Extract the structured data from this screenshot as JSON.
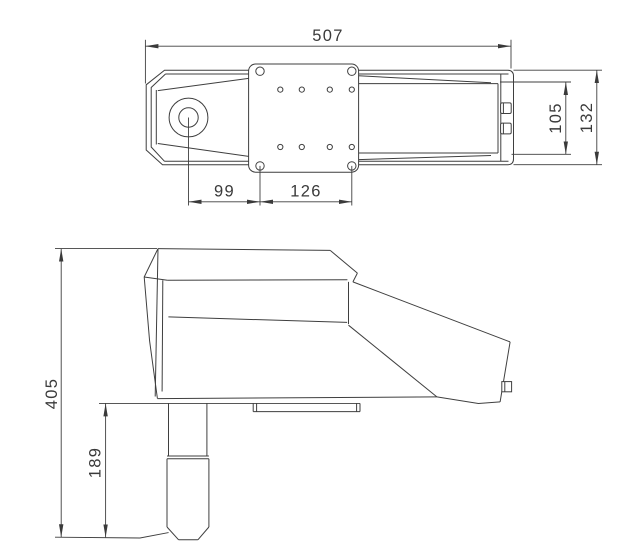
{
  "drawing": {
    "type": "technical-orthographic-drawing",
    "views": {
      "top_view": "device top view with mounting plate",
      "side_view": "device side view with support pole"
    }
  },
  "dimensions": {
    "overall_length": "507",
    "lens_to_mount": "99",
    "mount_hole_spacing": "126",
    "body_inner_height": "105",
    "body_outer_height": "132",
    "overall_height": "405",
    "pole_length": "189"
  },
  "colors": {
    "line": "#3f3f3f",
    "text": "#3a3a3a",
    "background": "#ffffff"
  }
}
